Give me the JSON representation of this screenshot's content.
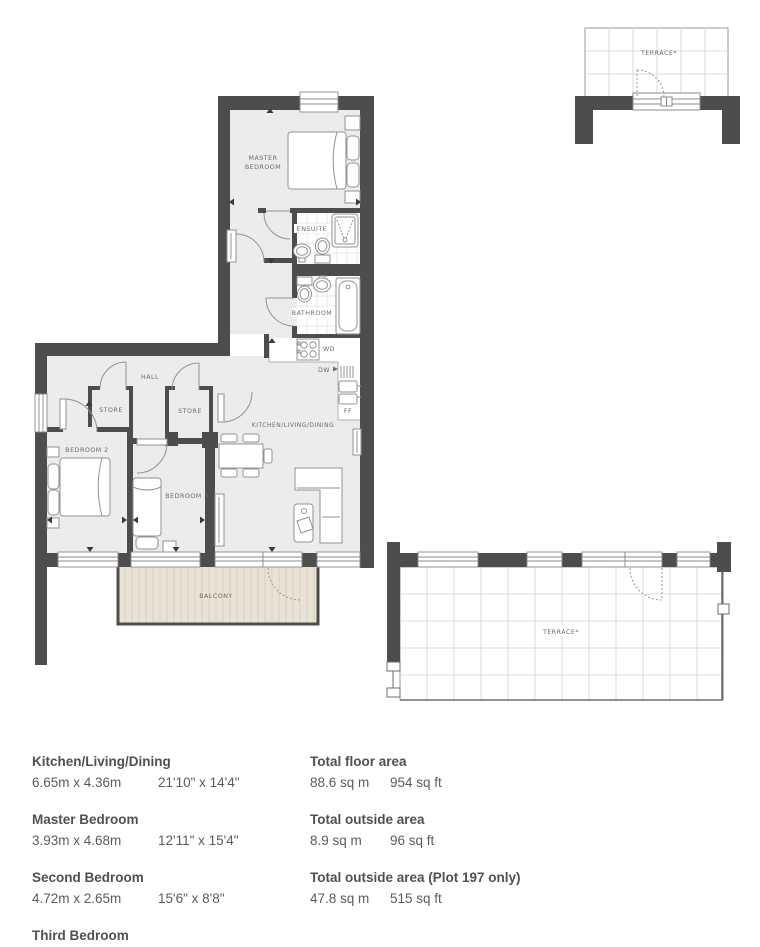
{
  "plan": {
    "labels": {
      "master_bedroom_line1": "MASTER",
      "master_bedroom_line2": "BEDROOM",
      "ensuite": "ENSUITE",
      "bathroom": "BATHROOM",
      "hall": "HALL",
      "store_1": "STORE",
      "store_2": "STORE",
      "bedroom_2": "BEDROOM 2",
      "bedroom_3": "BEDROOM 3",
      "kitchen_living_dining": "KITCHEN/LIVING/DINING",
      "balcony": "BALCONY",
      "terrace_upper": "TERRACE*",
      "terrace_lower": "TERRACE*",
      "wd": "WD",
      "dw": "DW",
      "ff": "FF"
    },
    "colors": {
      "wall": "#4d4d4d",
      "room_fill": "#ececec",
      "balcony_fill": "#e9e3d6",
      "balcony_stripe": "#d9d2c3",
      "furniture_stroke": "#909294",
      "grid_line": "#d3d3d3",
      "label_text": "#6b6b6b"
    }
  },
  "legend": {
    "rooms": [
      {
        "name": "Kitchen/Living/Dining",
        "metric": "6.65m x 4.36m",
        "imperial": "21'10\" x 14'4\""
      },
      {
        "name": "Master Bedroom",
        "metric": "3.93m x 4.68m",
        "imperial": "12'11\" x 15'4\""
      },
      {
        "name": "Second Bedroom",
        "metric": "4.72m x 2.65m",
        "imperial": "15'6\" x 8'8\""
      },
      {
        "name": "Third Bedroom",
        "metric": "3.47m x 2.55m",
        "imperial": "11'5\" x 8'4\""
      }
    ],
    "totals": [
      {
        "name": "Total floor area",
        "metric": "88.6 sq m",
        "imperial": "954 sq ft"
      },
      {
        "name": "Total outside area",
        "metric": "8.9 sq m",
        "imperial": "96 sq ft"
      },
      {
        "name": "Total outside area (Plot 197 only)",
        "metric": "47.8 sq m",
        "imperial": "515 sq ft"
      }
    ]
  }
}
